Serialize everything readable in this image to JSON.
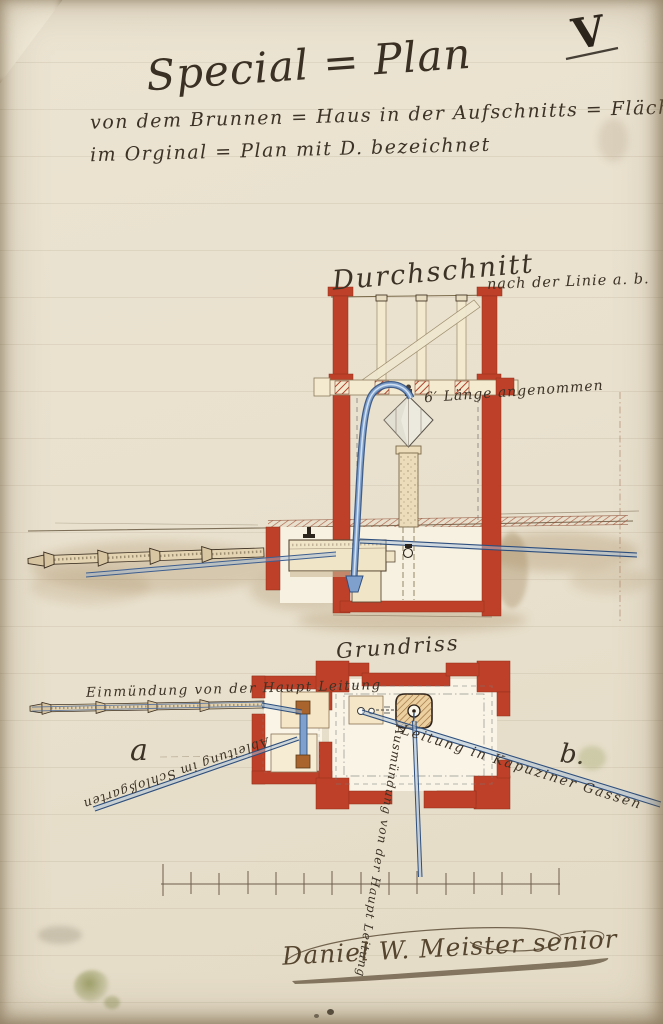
{
  "sheet": {
    "number": "V"
  },
  "title": {
    "main": "Special = Plan",
    "subtitle1": "von dem Brunnen = Haus in der Aufschnitts = Fläche",
    "subtitle2": "im Orginal = Plan mit D. bezeichnet"
  },
  "cross_section": {
    "heading": "Durchschnitt",
    "heading_detail": "nach der Linie a. b.",
    "length_note": "6′ Länge angenommen"
  },
  "ground_plan": {
    "heading": "Grundriss",
    "inlet_note": "Einmündung von der Haupt Leitung",
    "garden_line_note": "Ableitung im Schloßgarten",
    "kapuziner_line_note": "Leitung in Kapuziner Gassen",
    "main_outlet_note": "Ausmündung von der Haupt Leitung",
    "marker_a": "a",
    "marker_b": "b."
  },
  "signature": {
    "text": "Daniel W. Meister senior"
  },
  "colors": {
    "paper": "#eae2d0",
    "wall_red": "#bf4028",
    "pipe_blue": "#2e4f7d",
    "wood_tan": "#f2e3c2",
    "earth_sepia": "#a08257",
    "ink": "#3c3226"
  }
}
